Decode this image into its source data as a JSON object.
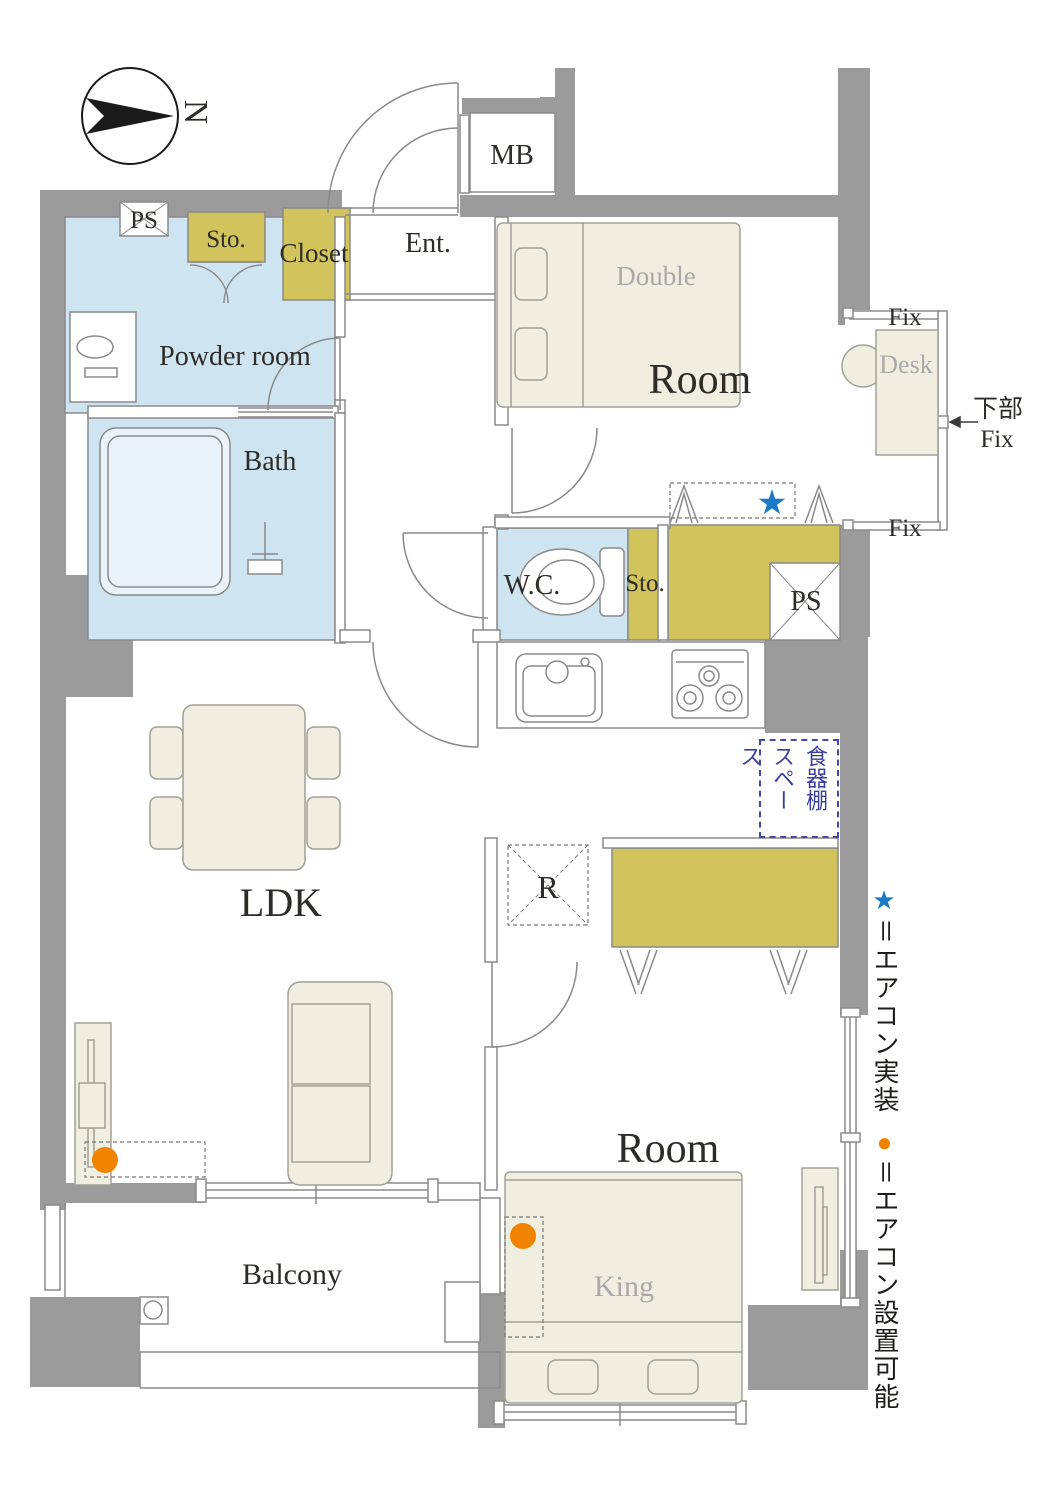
{
  "compass": {
    "north": "N"
  },
  "labels": {
    "ps_top": "PS",
    "sto_top": "Sto.",
    "closet": "Closet",
    "ent": "Ent.",
    "mb": "MB",
    "powder_room": "Powder room",
    "bath": "Bath",
    "room_top": "Room",
    "bed_double": "Double",
    "desk": "Desk",
    "fix": "Fix",
    "lower_fix_jp": "下部",
    "lower_fix_en": "Fix",
    "wc": "W.C.",
    "sto_mid": "Sto.",
    "ps_right": "PS",
    "ldk": "LDK",
    "fridge": "R",
    "dish_shelf_space": "食器棚スペース",
    "room_bottom": "Room",
    "bed_king": "King",
    "balcony": "Balcony"
  },
  "legend": {
    "star_symbol": "★",
    "star_text": "＝エアコン実装",
    "dot_symbol": "●",
    "dot_text": "＝エアコン設置可能"
  },
  "colors": {
    "wall": "#9b9b9b",
    "water_area": "#cfe4f1",
    "storage": "#d2c45c",
    "furniture": "#efeee1",
    "aircon_installed": "#1b7ac5",
    "aircon_possible": "#f08300",
    "dish_note_text": "#3a3f9e"
  }
}
